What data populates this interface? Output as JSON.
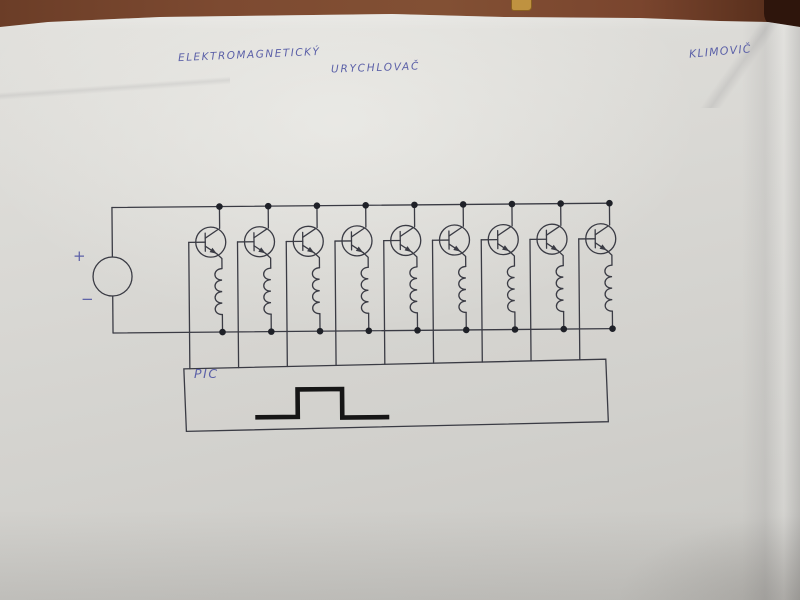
{
  "scene": {
    "description": "Photograph of a hand-drawn electronic schematic on a white paper sheet lying on a brown wooden table",
    "table_color": "#7b4830",
    "paper_color": "#d8d7d3"
  },
  "handwriting": {
    "ink_color": "#5c61a8",
    "title_line1": "ELEKTROMAGNETICKÝ",
    "title_line2": "URYCHLOVAČ",
    "author": "KLIMOVIČ"
  },
  "schematic": {
    "line_color": "#3a3b44",
    "dot_color": "#1f2128",
    "source": {
      "plus_label": "+",
      "minus_label": "−",
      "symbol": "circle DC source"
    },
    "stage_count": 9,
    "stage": {
      "transistor": "NPN",
      "load": "solenoid coil",
      "base_drive": "PIC output line"
    },
    "controller": {
      "label": "PIC",
      "waveform": "single rectangular pulse",
      "waveform_color": "#161616"
    }
  }
}
